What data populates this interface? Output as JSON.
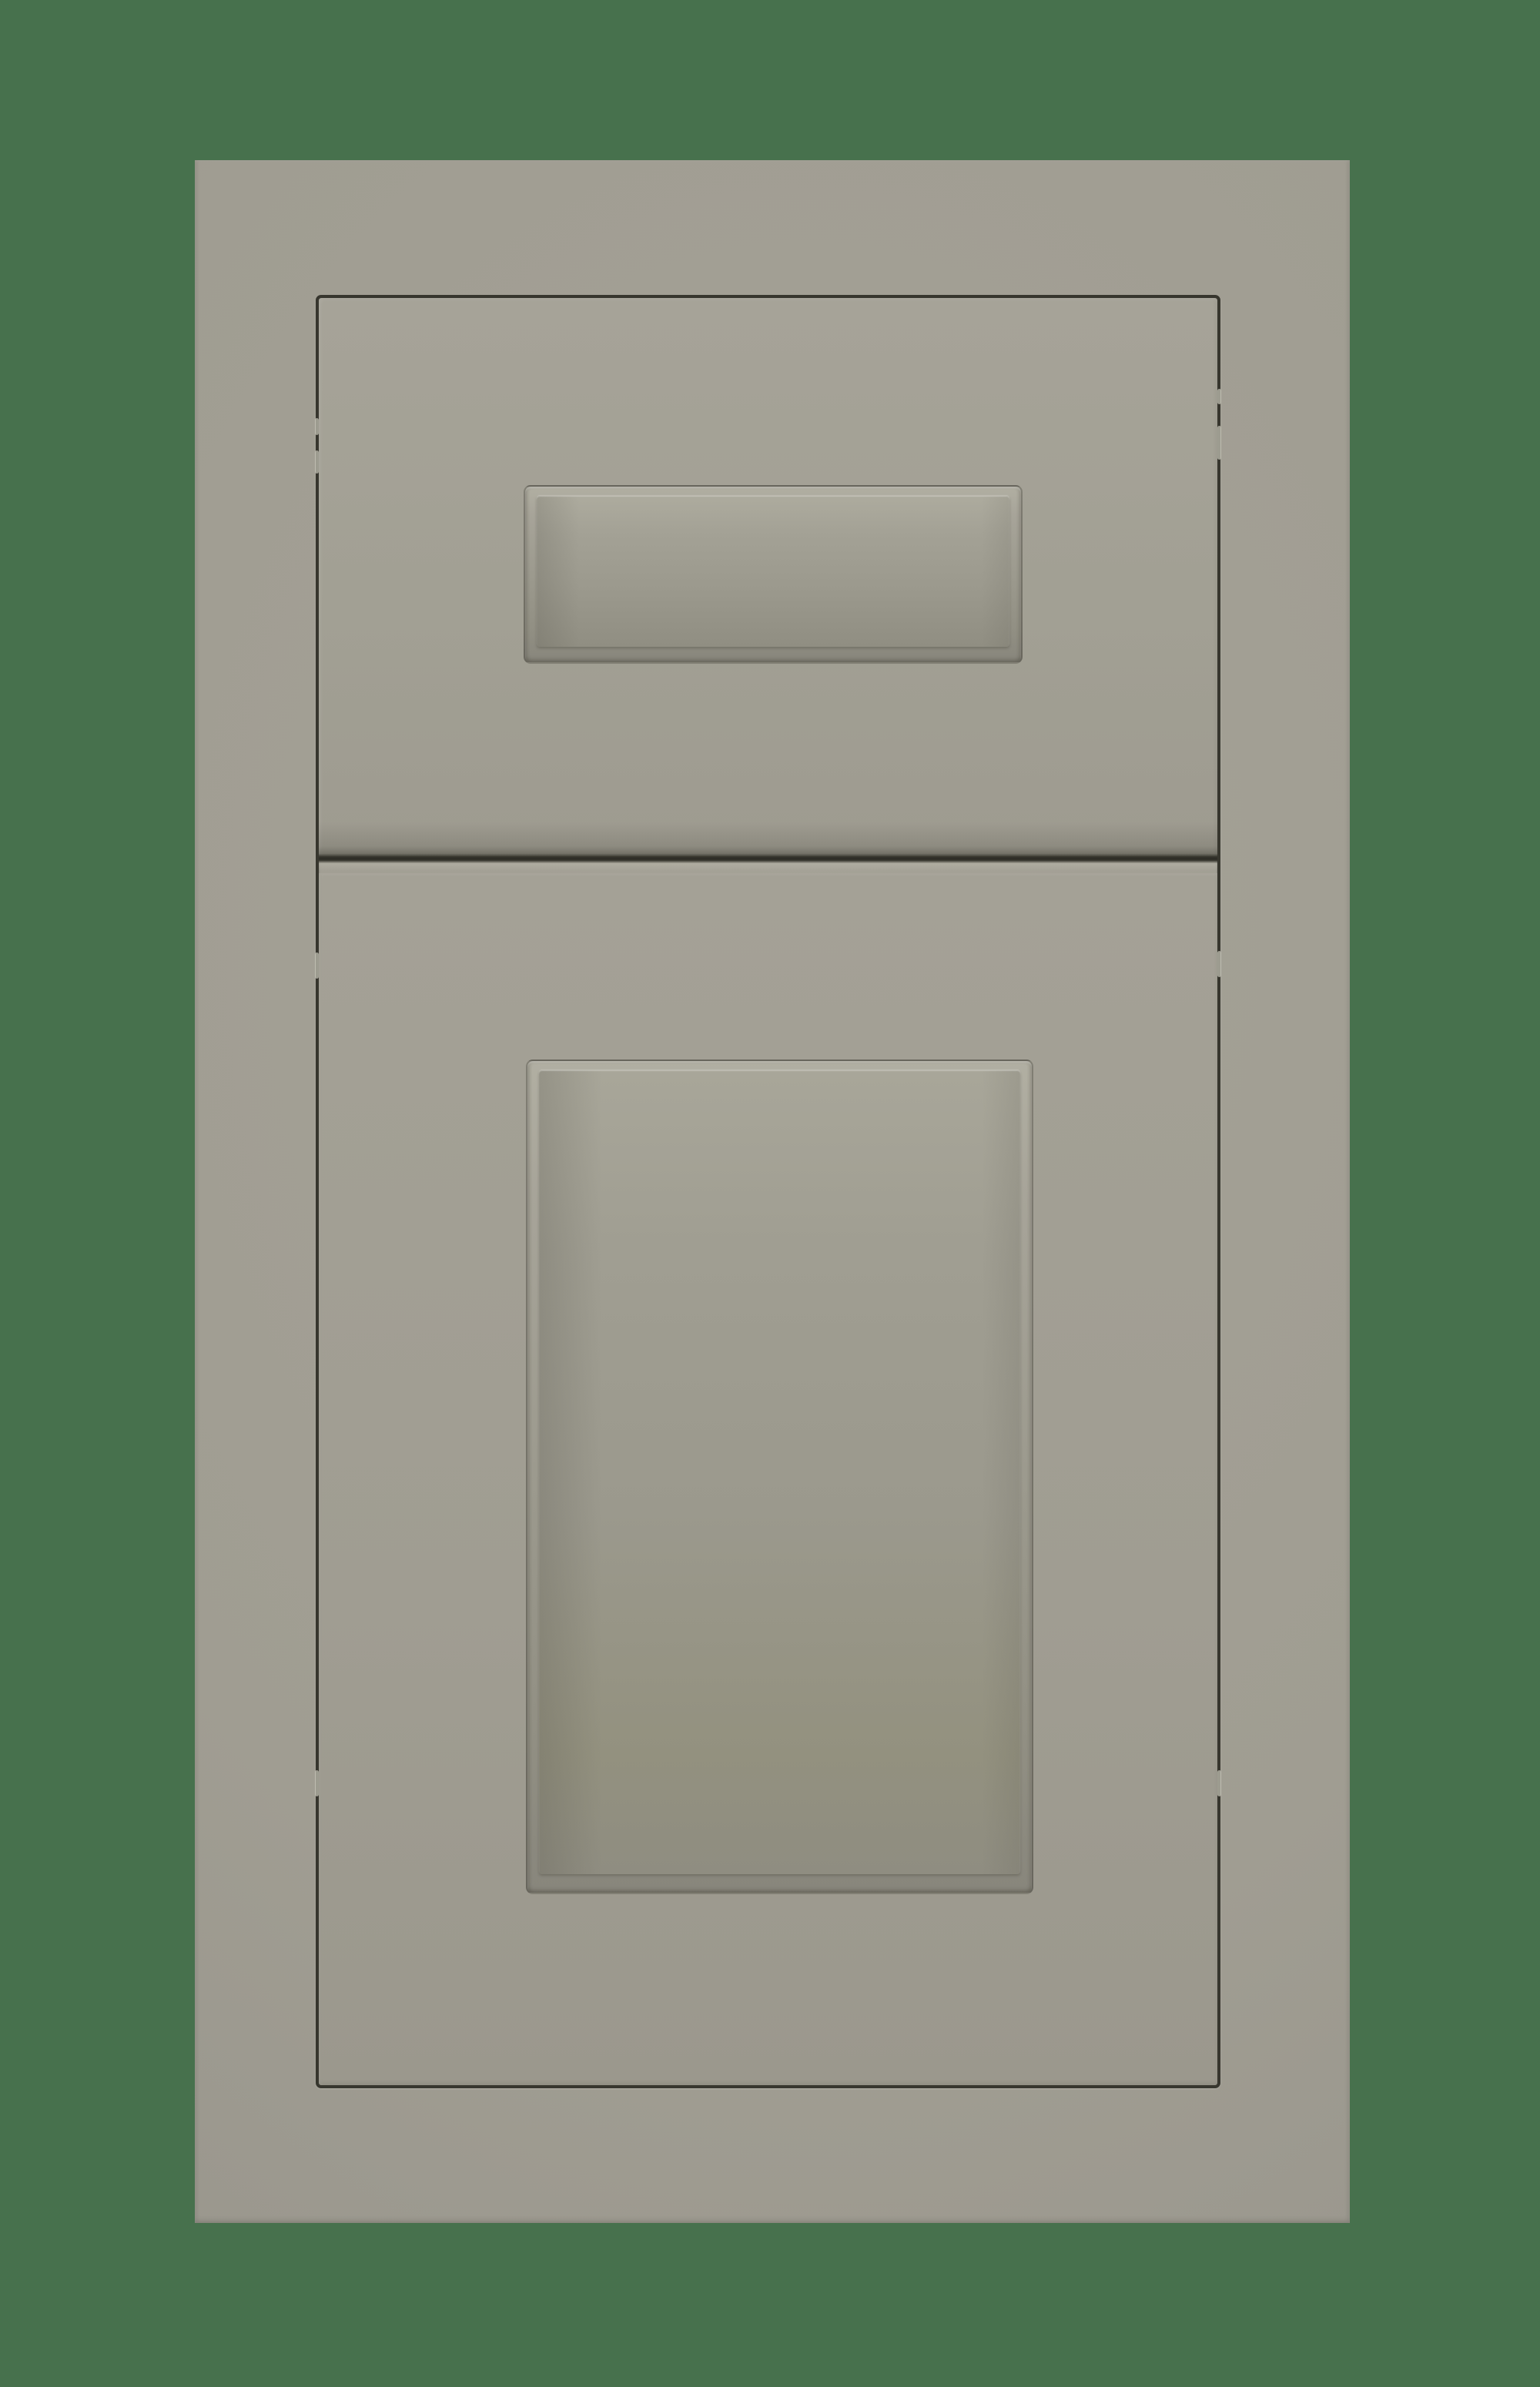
{
  "scene": {
    "description": "Studio product photo of a painted greige shaker-style cabinet sample, with a slab drawer front above a recessed-panel cabinet door, centered on a solid dark-green backdrop",
    "subject": "shaker-cabinet-door-sample",
    "photo_elements": {
      "backdrop": "solid dark green background",
      "frame": "flat outer face frame of the sample",
      "drawer_front": "upper drawer front with recessed rectangular center panel",
      "door_front": "lower cabinet door with tall recessed rectangular center panel",
      "reveal_gap": "thin dark shadow gap outlining the drawer and door fronts",
      "glints": "small light reflections along the reveal gap"
    }
  },
  "palette": {
    "backdrop": "#47714d",
    "slab_center": "#a5a297",
    "slab_edge": "#95928a",
    "recess_hi": "#b1afa2",
    "recess_mid": "#9c9a8e",
    "recess_lo": "#88867c",
    "panel_hi": "#adab9e",
    "panel_lo": "#908e82",
    "gap_line": "#37362e",
    "gap_glint": "#c9c7ba"
  }
}
